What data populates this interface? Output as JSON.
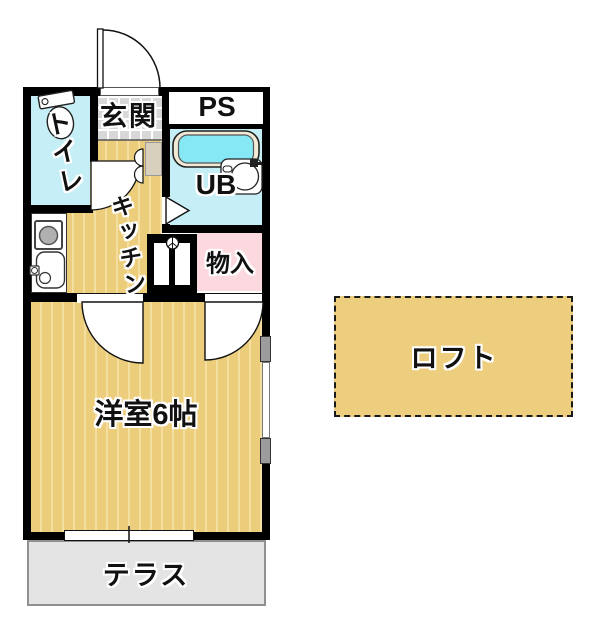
{
  "title": "1K apartment floor plan",
  "rooms": {
    "toilet": {
      "label": "トイレ"
    },
    "entrance": {
      "label": "玄関"
    },
    "pipe_space": {
      "label": "PS"
    },
    "unit_bath": {
      "label": "UB"
    },
    "kitchen": {
      "label": "キッチン"
    },
    "storage": {
      "label": "物入"
    },
    "western_room": {
      "label": "洋室6帖"
    },
    "terrace": {
      "label": "テラス"
    },
    "loft": {
      "label": "ロフト"
    }
  },
  "fixtures": {
    "toilet": "toilet-icon",
    "bathtub": "bathtub-icon",
    "basin": "basin-icon",
    "stove": "stove-icon",
    "sink": "sink-icon",
    "washing_machine": "washer-icon",
    "doors": "door-swing-arc",
    "window": "sliding-window"
  },
  "colors": {
    "wall": "#000000",
    "floor_tatami": "#eccd7c",
    "floor_stripe": "#f5dfa0",
    "water_room": "#c6eef6",
    "bathtub_fill": "#86e8f5",
    "storage_pink": "#fbd9de",
    "entrance_tile": "#d8d8d8",
    "terrace_gray": "#e4e4e4",
    "loft_fill": "#ecce7e",
    "text": "#111111"
  }
}
